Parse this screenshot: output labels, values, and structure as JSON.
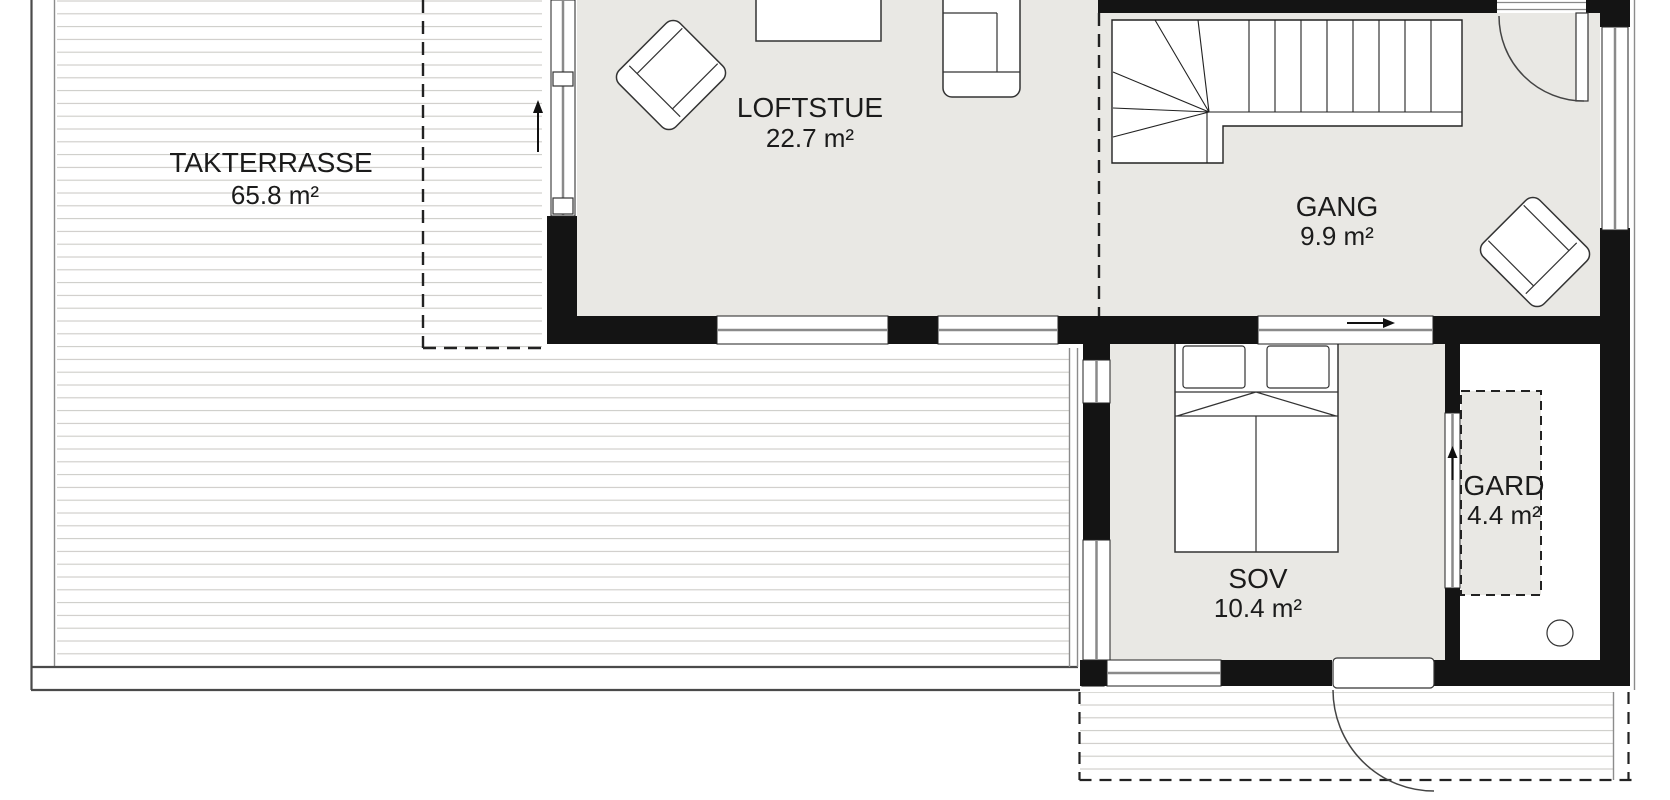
{
  "title": "Loft floor plan",
  "colors": {
    "wall": "#141414",
    "floor": "#e9e8e4",
    "deckline": "#cccbc7",
    "edge": "#4a4a4a",
    "text": "#1b1b1b"
  },
  "rooms": [
    {
      "id": "takterrasse",
      "name": "TAKTERRASSE",
      "area": "65.8 m²"
    },
    {
      "id": "loftstue",
      "name": "LOFTSTUE",
      "area": "22.7 m²"
    },
    {
      "id": "gang",
      "name": "GANG",
      "area": "9.9 m²"
    },
    {
      "id": "sov",
      "name": "SOV",
      "area": "10.4 m²"
    },
    {
      "id": "gard",
      "name": "GARD",
      "area": "4.4 m²"
    }
  ]
}
